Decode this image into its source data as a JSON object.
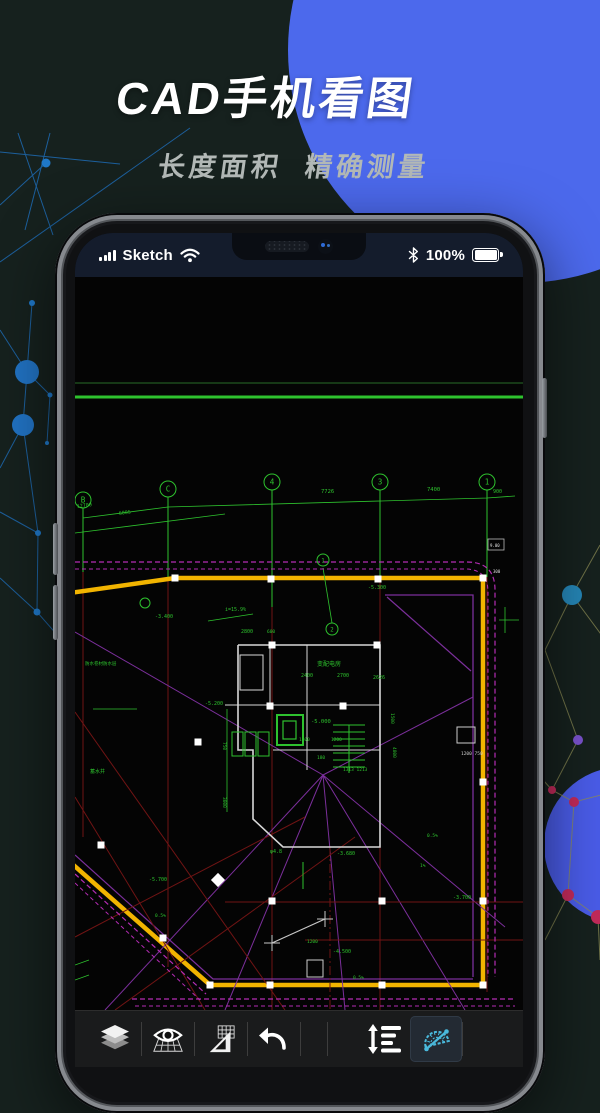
{
  "header": {
    "title": "CAD手机看图",
    "subtitle": "长度面积  精确测量"
  },
  "status_bar": {
    "carrier": "Sketch",
    "battery_percent": "100%",
    "icons": [
      "signal-icon",
      "wifi-icon",
      "bluetooth-icon",
      "battery-icon"
    ]
  },
  "toolbar": {
    "items": [
      {
        "id": "layers",
        "icon": "layers-icon",
        "active": false
      },
      {
        "id": "view",
        "icon": "eye-grid-icon",
        "active": false
      },
      {
        "id": "set-square",
        "icon": "set-square-icon",
        "active": false
      },
      {
        "id": "undo",
        "icon": "undo-icon",
        "active": false
      },
      {
        "id": "line-spacing",
        "icon": "line-spacing-icon",
        "active": false
      },
      {
        "id": "protractor",
        "icon": "protractor-icon",
        "active": true
      }
    ]
  },
  "colors": {
    "background": "#16211e",
    "hero_circle_blue": "#4c69ec",
    "circle_indigo": "#5b66f2",
    "circle_blue_right": "#4a5ce8",
    "statusbar_bg": "#141c2c",
    "toolbar_bg": "#1a1b1c",
    "active_tool_cyan": "#4ab9dc",
    "cad_yellow": "#f2b400",
    "cad_magenta": "#b42cb4",
    "cad_purple": "#7b2f9b",
    "cad_red": "#701414",
    "cad_green": "#2ec22e",
    "cad_wall_white": "#d8d8d8"
  },
  "cad": {
    "colors": {
      "axis": "#2ec22e",
      "dim_text": "#2ec22e"
    },
    "lines": [
      {
        "p": "0,106 448,106",
        "c": "#1d4a1d",
        "w": 1.5
      },
      {
        "p": "0,120 448,120",
        "c": "#2ec22e",
        "w": 3
      },
      {
        "p": "8,231 8,295",
        "c": "#2ec22e",
        "w": 1
      },
      {
        "p": "93,220 93,300",
        "c": "#2ec22e",
        "w": 1
      },
      {
        "p": "197,213 197,330",
        "c": "#2ec22e",
        "w": 1
      },
      {
        "p": "305,213 305,300",
        "c": "#2ec22e",
        "w": 1
      },
      {
        "p": "412,213 412,300",
        "c": "#2ec22e",
        "w": 1
      },
      {
        "p": "8,295 8,560",
        "c": "#701414",
        "w": 1
      },
      {
        "p": "93,300 93,690",
        "c": "#701414",
        "w": 1
      },
      {
        "p": "197,330 197,733",
        "c": "#701414",
        "w": 1
      },
      {
        "p": "305,300 305,733",
        "c": "#701414",
        "w": 1
      },
      {
        "p": "412,300 412,715",
        "c": "#701414",
        "w": 1
      },
      {
        "p": "8,241 93,230 412,221 440,219",
        "c": "#2ec22e",
        "w": 0.8
      },
      {
        "p": "0,256 150,237",
        "c": "#2ec22e",
        "w": 0.8
      },
      {
        "p": "-5,316 100,301 408,301 408,708 135,708 -5,585",
        "c": "#f2b400",
        "w": 4.5
      },
      {
        "p": "310,318 398,318 398,700",
        "c": "#7b2f9b",
        "w": 1.3
      },
      {
        "p": "312,320 396,394",
        "c": "#7b2f9b",
        "w": 1.2
      },
      {
        "p": "0,578 138,702 398,702",
        "c": "#7b2f9b",
        "w": 1.2
      },
      {
        "p": "0,355 248,498 390,733",
        "c": "#7b2f9b",
        "w": 1
      },
      {
        "p": "248,498 30,733",
        "c": "#7b2f9b",
        "w": 1
      },
      {
        "p": "248,498 150,733",
        "c": "#7b2f9b",
        "w": 1
      },
      {
        "p": "248,498 270,733",
        "c": "#7b2f9b",
        "w": 1
      },
      {
        "p": "248,498 430,650",
        "c": "#7b2f9b",
        "w": 1
      },
      {
        "p": "248,498 398,420",
        "c": "#7b2f9b",
        "w": 1
      },
      {
        "p": "150,625 448,625",
        "c": "#701414",
        "w": 1
      },
      {
        "p": "230,663 448,663",
        "c": "#701414",
        "w": 1
      },
      {
        "p": "0,435 210,733",
        "c": "#701414",
        "w": 1
      },
      {
        "p": "0,520 130,733",
        "c": "#701414",
        "w": 1
      },
      {
        "p": "0,660 230,540",
        "c": "#701414",
        "w": 1
      },
      {
        "p": "40,733 280,560",
        "c": "#701414",
        "w": 1
      },
      {
        "p": "255,570 255,733",
        "c": "#701414",
        "w": 1,
        "d": "9 3 2 3"
      },
      {
        "p": "197,666 250,642",
        "c": "#c8c8c8",
        "w": 1.2
      },
      {
        "p": "189,666 205,666",
        "c": "#c8c8c8",
        "w": 1
      },
      {
        "p": "197,658 197,674",
        "c": "#c8c8c8",
        "w": 1
      },
      {
        "p": "242,642 258,642",
        "c": "#c8c8c8",
        "w": 1
      },
      {
        "p": "250,634 250,650",
        "c": "#c8c8c8",
        "w": 1
      },
      {
        "p": "163,368 305,368 305,570 208,570 178,542 178,473 163,473 163,368",
        "c": "#d8d8d8",
        "w": 1.6
      },
      {
        "p": "150,428 305,428",
        "c": "#d8d8d8",
        "w": 1
      },
      {
        "p": "195,368 195,428",
        "c": "#d8d8d8",
        "w": 1
      },
      {
        "p": "232,368 232,493",
        "c": "#d8d8d8",
        "w": 1
      },
      {
        "p": "198,473 305,473",
        "c": "#d8d8d8",
        "w": 1
      },
      {
        "p": "258,448 290,448",
        "c": "#2ec22e",
        "w": 1
      },
      {
        "p": "258,455 290,455",
        "c": "#2ec22e",
        "w": 1
      },
      {
        "p": "258,462 290,462",
        "c": "#2ec22e",
        "w": 1
      },
      {
        "p": "258,469 290,469",
        "c": "#2ec22e",
        "w": 1
      },
      {
        "p": "258,476 290,476",
        "c": "#2ec22e",
        "w": 1
      },
      {
        "p": "258,483 290,483",
        "c": "#2ec22e",
        "w": 1
      },
      {
        "p": "258,490 290,490",
        "c": "#2ec22e",
        "w": 1
      },
      {
        "p": "274,448 274,496",
        "c": "#2ec22e",
        "w": 1
      },
      {
        "p": "228,585 228,612",
        "c": "#2ec22e",
        "w": 1
      },
      {
        "p": "152,432 152,535",
        "c": "#2ec22e",
        "w": 0.8
      },
      {
        "p": "430,330 430,356",
        "c": "#2ec22e",
        "w": 0.8
      },
      {
        "p": "424,343 444,343",
        "c": "#2ec22e",
        "w": 0.8
      },
      {
        "p": "133,344 178,337",
        "c": "#2ec22e",
        "w": 0.8
      },
      {
        "p": "18,432 62,432",
        "c": "#2ec22e",
        "w": 0.8
      },
      {
        "p": "248,291 257,346",
        "c": "#2ec22e",
        "w": 0.8
      },
      {
        "p": "0,688 14,683",
        "c": "#2ec22e",
        "w": 0.8
      },
      {
        "p": "0,703 14,698",
        "c": "#2ec22e",
        "w": 0.8
      }
    ],
    "paths": [
      {
        "d": "M0,285 L392,285 Q420,285 420,313 L420,700",
        "c": "#b42cb4",
        "w": 1.2,
        "dash": "5 3"
      },
      {
        "d": "M0,292 L390,292 Q413,292 413,315 L413,700",
        "c": "#b42cb4",
        "w": 1,
        "dash": "4 3"
      },
      {
        "d": "M57,722 L438,722",
        "c": "#b42cb4",
        "w": 1.2,
        "dash": "5 3"
      },
      {
        "d": "M60,729 L440,729",
        "c": "#b42cb4",
        "w": 1,
        "dash": "4 3"
      },
      {
        "d": "M0,597 L131,717",
        "c": "#b42cb4",
        "w": 1.2,
        "dash": "5 3"
      },
      {
        "d": "M0,606 L125,723",
        "c": "#b42cb4",
        "w": 1,
        "dash": "4 3"
      }
    ],
    "rects": [
      {
        "x": 165,
        "y": 378,
        "w": 23,
        "h": 35,
        "c": "#d8d8d8",
        "wd": 1
      },
      {
        "x": 202,
        "y": 438,
        "w": 26,
        "h": 30,
        "c": "#2ec22e",
        "wd": 2
      },
      {
        "x": 208,
        "y": 444,
        "w": 13,
        "h": 18,
        "c": "#2ec22e",
        "wd": 1.2
      },
      {
        "x": 157,
        "y": 455,
        "w": 11,
        "h": 24,
        "c": "#2ec22e",
        "wd": 1
      },
      {
        "x": 170,
        "y": 455,
        "w": 11,
        "h": 24,
        "c": "#2ec22e",
        "wd": 1
      },
      {
        "x": 183,
        "y": 455,
        "w": 11,
        "h": 24,
        "c": "#2ec22e",
        "wd": 1
      },
      {
        "x": 232,
        "y": 683,
        "w": 16,
        "h": 17,
        "c": "#cccccc",
        "wd": 1
      },
      {
        "x": 413,
        "y": 262,
        "w": 16,
        "h": 11,
        "c": "#bbbbbb",
        "wd": 0.8
      },
      {
        "x": 382,
        "y": 450,
        "w": 18,
        "h": 16,
        "c": "#cccccc",
        "wd": 1
      }
    ],
    "bubbles": [
      {
        "x": 8,
        "y": 223,
        "l": "B"
      },
      {
        "x": 93,
        "y": 212,
        "l": "C"
      },
      {
        "x": 197,
        "y": 205,
        "l": "4"
      },
      {
        "x": 305,
        "y": 205,
        "l": "3"
      },
      {
        "x": 412,
        "y": 205,
        "l": "1"
      },
      {
        "x": 248,
        "y": 283,
        "l": "1",
        "r": 6
      },
      {
        "x": 257,
        "y": 352,
        "l": "2",
        "r": 6
      },
      {
        "x": 70,
        "y": 326,
        "l": "",
        "r": 5
      }
    ],
    "grips": [
      [
        100,
        301
      ],
      [
        196,
        302
      ],
      [
        303,
        302
      ],
      [
        408,
        301
      ],
      [
        408,
        505
      ],
      [
        408,
        624
      ],
      [
        408,
        708
      ],
      [
        307,
        708
      ],
      [
        195,
        708
      ],
      [
        135,
        708
      ],
      [
        88,
        661
      ],
      [
        26,
        568
      ],
      [
        123,
        465
      ],
      [
        197,
        624
      ],
      [
        307,
        624
      ],
      [
        197,
        368
      ],
      [
        302,
        368
      ],
      [
        195,
        429
      ],
      [
        268,
        429
      ]
    ],
    "diamond_grips": [
      [
        143,
        603
      ]
    ],
    "texts": [
      {
        "x": 2,
        "y": 231,
        "t": "12700",
        "r": -7,
        "s": 5
      },
      {
        "x": 44,
        "y": 238,
        "t": "6005",
        "r": -7,
        "s": 5
      },
      {
        "x": 246,
        "y": 216,
        "t": "7726",
        "s": 5.5
      },
      {
        "x": 352,
        "y": 214,
        "t": "7400",
        "s": 5.5
      },
      {
        "x": 418,
        "y": 216,
        "t": "900",
        "s": 5
      },
      {
        "x": 150,
        "y": 334,
        "t": "i=15.9%",
        "s": 5
      },
      {
        "x": 80,
        "y": 341,
        "t": "-3.400",
        "s": 5
      },
      {
        "x": 293,
        "y": 312,
        "t": "-5.300",
        "s": 5
      },
      {
        "x": 166,
        "y": 356,
        "t": "2800",
        "s": 5
      },
      {
        "x": 192,
        "y": 356,
        "t": "600",
        "s": 4.5
      },
      {
        "x": 226,
        "y": 400,
        "t": "2400",
        "s": 5
      },
      {
        "x": 262,
        "y": 400,
        "t": "2700",
        "s": 5
      },
      {
        "x": 298,
        "y": 402,
        "t": "2626",
        "s": 5
      },
      {
        "x": 242,
        "y": 389,
        "t": "变配电房",
        "s": 6
      },
      {
        "x": 10,
        "y": 388,
        "t": "防水卷材防水层",
        "s": 4.5
      },
      {
        "x": 130,
        "y": 428,
        "t": "-5.200",
        "s": 5
      },
      {
        "x": 236,
        "y": 446,
        "t": "-5.000",
        "s": 5.5
      },
      {
        "x": 224,
        "y": 464,
        "t": "1300",
        "s": 4.5
      },
      {
        "x": 256,
        "y": 464,
        "t": "1200",
        "s": 4.5
      },
      {
        "x": 242,
        "y": 482,
        "t": "180",
        "s": 4.5
      },
      {
        "x": 268,
        "y": 494,
        "t": "1313 1213",
        "s": 4.5
      },
      {
        "x": 318,
        "y": 470,
        "t": "4800",
        "r": 90,
        "s": 4.5
      },
      {
        "x": 316,
        "y": 436,
        "t": "1500",
        "r": 90,
        "s": 4.5
      },
      {
        "x": 15,
        "y": 496,
        "t": "蓄水井",
        "s": 5
      },
      {
        "x": 148,
        "y": 465,
        "t": "750",
        "r": 90,
        "s": 4.5
      },
      {
        "x": 148,
        "y": 520,
        "t": "3000",
        "r": 90,
        "s": 4.5
      },
      {
        "x": 195,
        "y": 576,
        "t": "φ4.8",
        "s": 5
      },
      {
        "x": 262,
        "y": 578,
        "t": "-3.680",
        "s": 5
      },
      {
        "x": 352,
        "y": 560,
        "t": "0.5%",
        "s": 4.5
      },
      {
        "x": 345,
        "y": 590,
        "t": "1%",
        "s": 4.5
      },
      {
        "x": 74,
        "y": 604,
        "t": "-5.700",
        "s": 5
      },
      {
        "x": 80,
        "y": 640,
        "t": "0.5%",
        "s": 4.5
      },
      {
        "x": 378,
        "y": 622,
        "t": "-3.700",
        "s": 5
      },
      {
        "x": 232,
        "y": 666,
        "t": "1200",
        "s": 4.5
      },
      {
        "x": 258,
        "y": 676,
        "t": "-4.500",
        "s": 5
      },
      {
        "x": 278,
        "y": 702,
        "t": "0.5%",
        "s": 4.5
      },
      {
        "x": 386,
        "y": 478,
        "t": "1200 750",
        "s": 4.5,
        "c": "#cfcfcf"
      },
      {
        "x": 415,
        "y": 270,
        "t": "9.00",
        "s": 4,
        "c": "#e0e0e0"
      },
      {
        "x": 418,
        "y": 296,
        "t": "300",
        "s": 4,
        "c": "#e0e0e0"
      }
    ]
  }
}
